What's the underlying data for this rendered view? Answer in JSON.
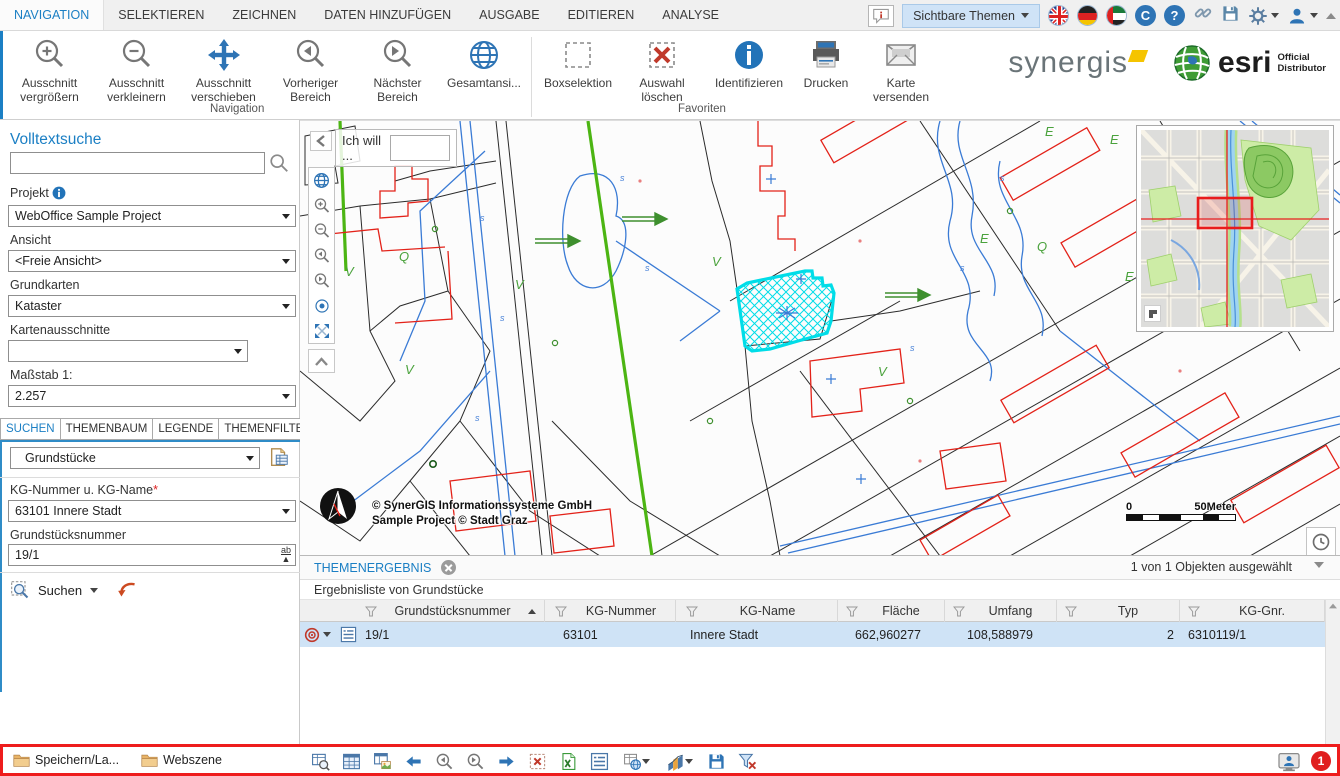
{
  "menu": {
    "tabs": [
      "NAVIGATION",
      "SELEKTIEREN",
      "ZEICHNEN",
      "DATEN HINZUFÜGEN",
      "AUSGABE",
      "EDITIEREN",
      "ANALYSE"
    ],
    "sichtbare_themen": "Sichtbare Themen"
  },
  "ribbon": {
    "buttons": [
      {
        "line1": "Ausschnitt",
        "line2": "vergrößern"
      },
      {
        "line1": "Ausschnitt",
        "line2": "verkleinern"
      },
      {
        "line1": "Ausschnitt",
        "line2": "verschieben"
      },
      {
        "line1": "Vorheriger",
        "line2": "Bereich"
      },
      {
        "line1": "Nächster",
        "line2": "Bereich"
      },
      {
        "line1": "Gesamtansi...",
        "line2": ""
      },
      {
        "line1": "Boxselektion",
        "line2": ""
      },
      {
        "line1": "Auswahl",
        "line2": "löschen"
      },
      {
        "line1": "Identifizieren",
        "line2": ""
      },
      {
        "line1": "Drucken",
        "line2": ""
      },
      {
        "line1": "Karte",
        "line2": "versenden"
      }
    ],
    "group_navigation": "Navigation",
    "group_favoriten": "Favoriten",
    "logo_synergis": "synergis",
    "logo_esri": "esri",
    "logo_esri_sub1": "Official",
    "logo_esri_sub2": "Distributor"
  },
  "sidebar": {
    "volltextsuche": "Volltextsuche",
    "projekt_label": "Projekt",
    "projekt_value": "WebOffice Sample Project",
    "ansicht_label": "Ansicht",
    "ansicht_value": "<Freie Ansicht>",
    "grundkarten_label": "Grundkarten",
    "grundkarten_value": "Kataster",
    "kartenausschnitte_label": "Kartenausschnitte",
    "kartenausschnitte_value": "",
    "massstab_label": "Maßstab 1:",
    "massstab_value": "2.257",
    "tabs": [
      "SUCHEN",
      "THEMENBAUM",
      "LEGENDE",
      "THEMENFILTER"
    ],
    "suchthema_value": "Grundstücke",
    "kg_label": "KG-Nummer u. KG-Name",
    "kg_required": "*",
    "kg_value": "63101 Innere Stadt",
    "gnr_label": "Grundstücksnummer",
    "gnr_value": "19/1",
    "ab_glyph": "ab",
    "suchen_label": "Suchen"
  },
  "map": {
    "ich_will": "Ich will ...",
    "copyright_line1": "© SynerGIS Informationssysteme GmbH",
    "copyright_line2": "Sample Project © Stadt Graz",
    "scale_left": "0",
    "scale_right": "50Meter",
    "labels": [
      {
        "t": "V",
        "x": 45,
        "y": 155,
        "c": "g"
      },
      {
        "t": "Q",
        "x": 99,
        "y": 140,
        "c": "g"
      },
      {
        "t": "V",
        "x": 105,
        "y": 253,
        "c": "g"
      },
      {
        "t": "V",
        "x": 215,
        "y": 168,
        "c": "g"
      },
      {
        "t": "V",
        "x": 412,
        "y": 145,
        "c": "g"
      },
      {
        "t": "V",
        "x": 578,
        "y": 255,
        "c": "g"
      },
      {
        "t": "E",
        "x": 745,
        "y": 15,
        "c": "g"
      },
      {
        "t": "E",
        "x": 810,
        "y": 23,
        "c": "g"
      },
      {
        "t": "E",
        "x": 680,
        "y": 122,
        "c": "g"
      },
      {
        "t": "E",
        "x": 825,
        "y": 160,
        "c": "g"
      },
      {
        "t": "Q",
        "x": 737,
        "y": 130,
        "c": "g"
      },
      {
        "t": "E",
        "x": 995,
        "y": 38,
        "c": "g"
      },
      {
        "t": "s",
        "x": 180,
        "y": 100,
        "c": "b"
      },
      {
        "t": "s",
        "x": 200,
        "y": 200,
        "c": "b"
      },
      {
        "t": "s",
        "x": 175,
        "y": 300,
        "c": "b"
      },
      {
        "t": "s",
        "x": 320,
        "y": 60,
        "c": "b"
      },
      {
        "t": "s",
        "x": 345,
        "y": 150,
        "c": "b"
      },
      {
        "t": "s",
        "x": 660,
        "y": 150,
        "c": "b"
      },
      {
        "t": "s",
        "x": 700,
        "y": 60,
        "c": "b"
      },
      {
        "t": "s",
        "x": 610,
        "y": 230,
        "c": "b"
      }
    ]
  },
  "results": {
    "tab": "THEMENERGEBNIS",
    "selection_info": "1 von 1 Objekten ausgewählt",
    "list_title": "Ergebnisliste von Grundstücke",
    "columns": [
      "Grundstücksnummer",
      "KG-Nummer",
      "KG-Name",
      "Fläche",
      "Umfang",
      "Typ",
      "KG-Gnr."
    ],
    "row": {
      "grundstuecksnummer": "19/1",
      "kg_nummer": "63101",
      "kg_name": "Innere Stadt",
      "flaeche": "662,960277",
      "umfang": "108,588979",
      "typ": "2",
      "kg_gnr": "6310119/1"
    }
  },
  "statusbar": {
    "item1": "Speichern/La...",
    "item2": "Webszene",
    "badge": "1"
  },
  "icons": {
    "question_glyph": "?",
    "crescent_glyph": "C"
  },
  "colors": {
    "accent": "#1b7fc4",
    "selection_cyan": "#00dde8",
    "highlight_red": "#ee1c1c",
    "row_selected": "#cfe3f6"
  }
}
